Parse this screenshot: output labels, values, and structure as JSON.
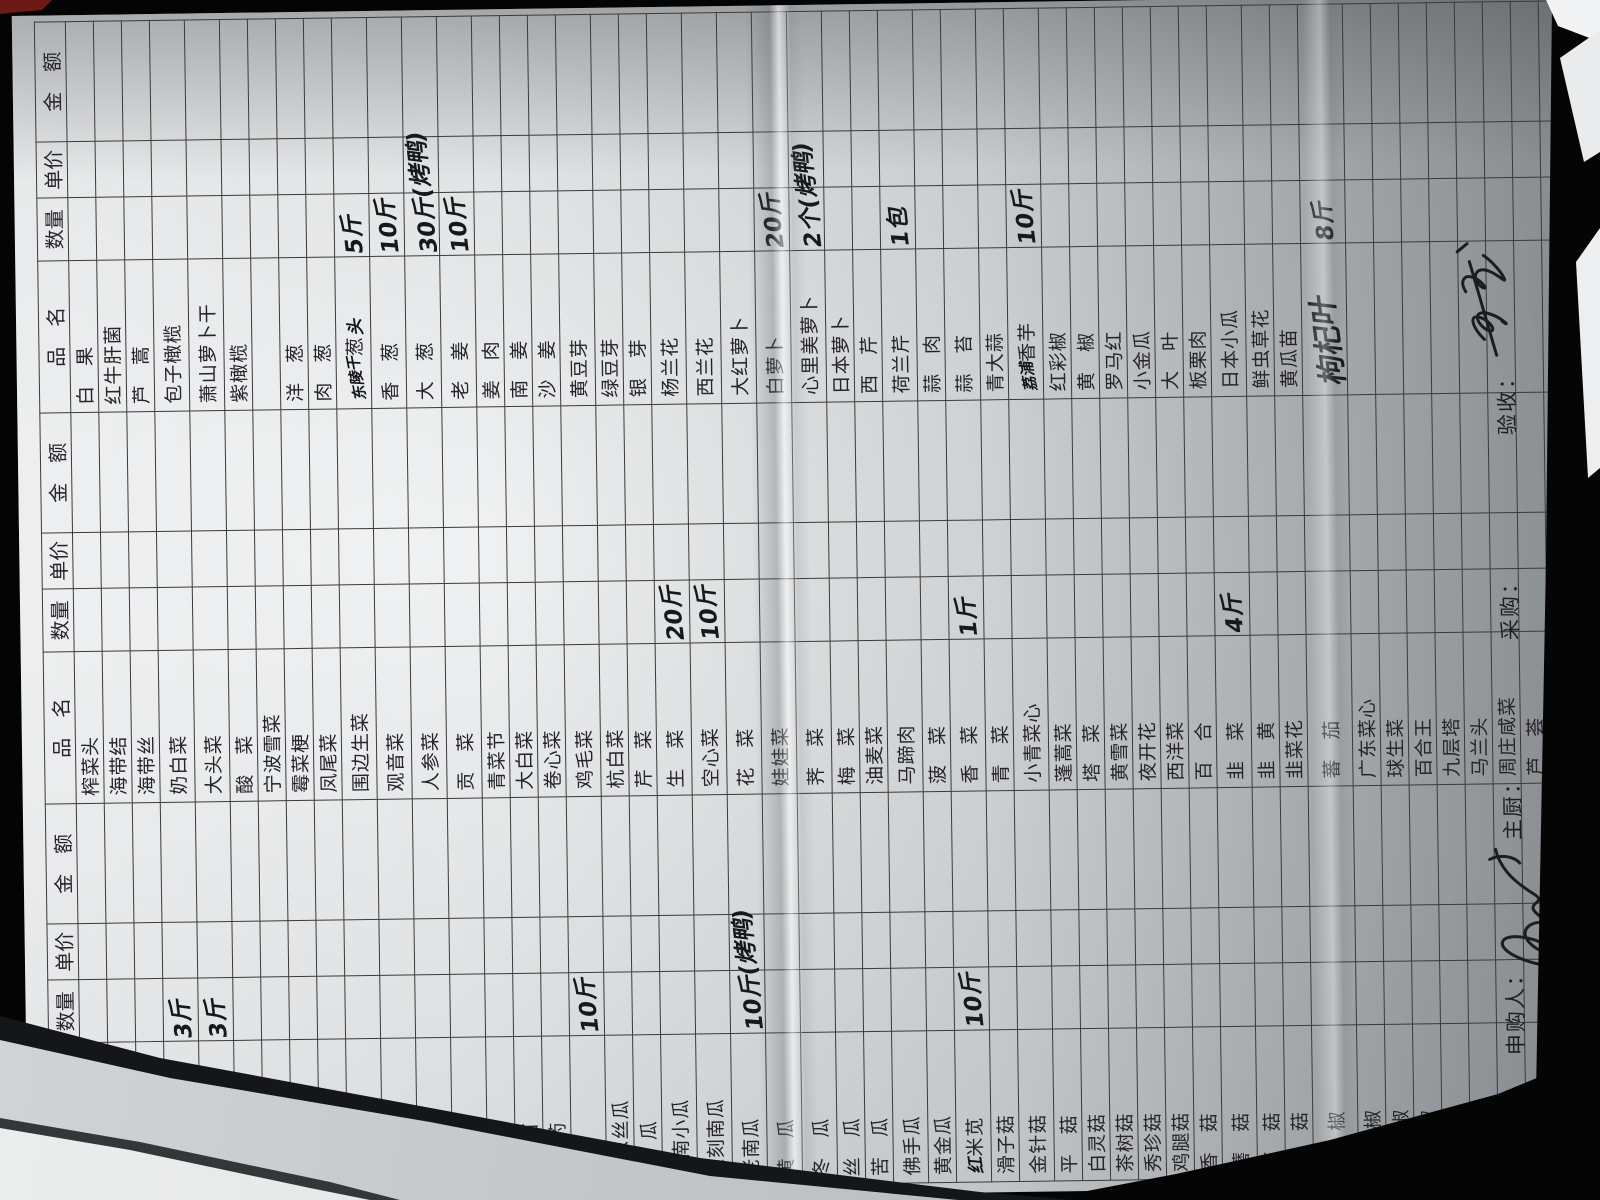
{
  "form": {
    "headers": {
      "name": "品　名",
      "qty": "数量",
      "price": "单价",
      "amount": "金　额"
    },
    "footer": {
      "requester": "申购人：",
      "chef": "主厨：",
      "purchaser": "采购：",
      "inspector": "验收："
    },
    "signatures": {
      "requester_signature": "手写签名(潦草)",
      "inspector_signature": "手写签名(潦草)"
    },
    "groups": [
      {
        "id": "left",
        "rows": [
          {},
          {
            "n": "节",
            "ind": 2
          },
          {
            "n": "毛豆米"
          },
          {
            "n": "荷兰豆",
            "q": "3斤"
          },
          {
            "n": "甜蜜豆",
            "q": "3斤"
          },
          {
            "n": "酸缸豆"
          },
          {
            "n": "土豆"
          },
          {
            "n": "小土豆"
          },
          {
            "n": "缸豆"
          },
          {
            "n": "刀豆"
          },
          {
            "n": "青豆板"
          },
          {
            "n": "茄子"
          },
          {
            "n": "草头"
          },
          {
            "n": "茭白"
          },
          {
            "n": "豆苗"
          },
          {
            "n": "山药"
          },
          {
            "n": "藕",
            "q": "10斤"
          },
          {
            "n": "广东丝瓜"
          },
          {
            "n": "地瓜"
          },
          {
            "n": "云南小瓜"
          },
          {
            "n": "雕刻南瓜"
          },
          {
            "n": "老南瓜",
            "q": "10斤(烤鸭)"
          },
          {
            "n": "黄瓜"
          },
          {
            "n": "冬瓜"
          },
          {
            "n": "丝瓜"
          },
          {
            "n": "苦瓜"
          },
          {
            "n": "佛手瓜"
          },
          {
            "n": "黄金瓜"
          },
          {
            "n": "米苋",
            "hp": "红",
            "q": "10斤"
          },
          {
            "n": "滑子菇"
          },
          {
            "n": "金针菇"
          },
          {
            "n": "平菇"
          },
          {
            "n": "白灵菇"
          },
          {
            "n": "茶树菇"
          },
          {
            "n": "秀珍菇"
          },
          {
            "n": "鸡腿菇"
          },
          {
            "n": "香菇"
          },
          {
            "n": "蘑菇"
          },
          {
            "n": "草菇"
          },
          {
            "n": "姬菇"
          },
          {
            "n": "黄椒"
          },
          {
            "n": "红尖椒"
          },
          {
            "n": "大红椒"
          },
          {
            "n": "青椒"
          },
          {
            "n": "青尖椒"
          },
          {
            "n": "杭椒"
          },
          {
            "n": "黄金笋"
          },
          {
            "n": "冬笋"
          },
          {
            "n": "竹笋"
          },
          {
            "n": "芦笋"
          },
          {
            "n": "香莴笋"
          },
          {
            "n": "水笋"
          }
        ]
      },
      {
        "id": "middle",
        "rows": [
          {
            "n": "榨菜头"
          },
          {
            "n": "海带结"
          },
          {
            "n": "海带丝"
          },
          {
            "n": "奶白菜"
          },
          {
            "n": "大头菜"
          },
          {
            "n": "酸菜"
          },
          {
            "n": "宁波雪菜"
          },
          {
            "n": "霉菜梗"
          },
          {
            "n": "凤尾菜"
          },
          {
            "n": "围边生菜"
          },
          {
            "n": "观音菜"
          },
          {
            "n": "人参菜"
          },
          {
            "n": "贡菜"
          },
          {
            "n": "青菜节"
          },
          {
            "n": "大白菜"
          },
          {
            "n": "卷心菜"
          },
          {
            "n": "鸡毛菜"
          },
          {
            "n": "杭白菜"
          },
          {
            "n": "芹菜"
          },
          {
            "n": "生菜",
            "q": "20斤"
          },
          {
            "n": "空心菜",
            "q": "10斤"
          },
          {
            "n": "花菜"
          },
          {
            "n": "娃娃菜"
          },
          {
            "n": "荠菜"
          },
          {
            "n": "梅菜"
          },
          {
            "n": "油麦菜"
          },
          {
            "n": "马蹄肉"
          },
          {
            "n": "菠菜"
          },
          {
            "n": "香菜",
            "q": "1斤"
          },
          {
            "n": "青菜"
          },
          {
            "n": "小青菜心"
          },
          {
            "n": "蓬蒿菜"
          },
          {
            "n": "塔菜"
          },
          {
            "n": "黄雪菜"
          },
          {
            "n": "夜开花"
          },
          {
            "n": "西洋菜"
          },
          {
            "n": "百合"
          },
          {
            "n": "韭菜",
            "q": "4斤"
          },
          {
            "n": "韭黄"
          },
          {
            "n": "韭菜花"
          },
          {
            "n": "蕃茄"
          },
          {
            "n": "广东菜心"
          },
          {
            "n": "球生菜"
          },
          {
            "n": "百合王"
          },
          {
            "n": "九层塔"
          },
          {
            "n": "马兰头"
          },
          {
            "n": "周庄咸菜"
          },
          {
            "n": "芦荟"
          },
          {
            "n": "广东芥兰"
          },
          {
            "n": "广东芥菜"
          },
          {
            "n": "细芥兰"
          },
          {
            "n": "紫芥兰"
          }
        ]
      },
      {
        "id": "right",
        "rows": [
          {
            "n": "白果"
          },
          {
            "n": "红牛肝菌"
          },
          {
            "n": "芦蒿"
          },
          {
            "n": "包子橄榄"
          },
          {
            "n": "萧山萝卜干"
          },
          {
            "n": "紫橄榄"
          },
          {},
          {
            "n": "洋葱"
          },
          {
            "n": "肉葱"
          },
          {
            "n": "葱",
            "hp": "东陵干",
            "hs": "头",
            "q": "5斤"
          },
          {
            "n": "香葱",
            "q": "10斤"
          },
          {
            "n": "大葱",
            "q": "30斤(烤鸭)"
          },
          {
            "n": "老姜",
            "q": "10斤"
          },
          {
            "n": "姜肉"
          },
          {
            "n": "南姜"
          },
          {
            "n": "沙姜"
          },
          {
            "n": "黄豆芽"
          },
          {
            "n": "绿豆芽"
          },
          {
            "n": "银芽"
          },
          {
            "n": "杨兰花"
          },
          {
            "n": "西兰花"
          },
          {
            "n": "大红萝卜"
          },
          {
            "n": "白萝卜",
            "q": "20斤"
          },
          {
            "n": "心里美萝卜",
            "q": "2个(烤鸭)"
          },
          {
            "n": "日本萝卜"
          },
          {
            "n": "西芹"
          },
          {
            "n": "荷兰芹",
            "q": "1包"
          },
          {
            "n": "蒜肉"
          },
          {
            "n": "蒜苔"
          },
          {
            "n": "青大蒜"
          },
          {
            "n": "香芋",
            "hp": "荔浦",
            "q": "10斤"
          },
          {
            "n": "红彩椒"
          },
          {
            "n": "黄椒"
          },
          {
            "n": "罗马红"
          },
          {
            "n": "小金瓜"
          },
          {
            "n": "大叶"
          },
          {
            "n": "板栗肉"
          },
          {
            "n": "日本小瓜"
          },
          {
            "n": "鲜虫草花"
          },
          {
            "n": "黄瓜苗"
          },
          {
            "h": "枸杞叶",
            "q": "8斤"
          },
          {},
          {},
          {},
          {},
          {},
          {},
          {},
          {},
          {},
          {},
          {}
        ]
      }
    ]
  },
  "colors": {
    "paper": "#dcdfe1",
    "grid_line": "#3c3a38",
    "printed_ink": "#26242a",
    "pen_ink": "#17181b",
    "background": "#040404"
  }
}
